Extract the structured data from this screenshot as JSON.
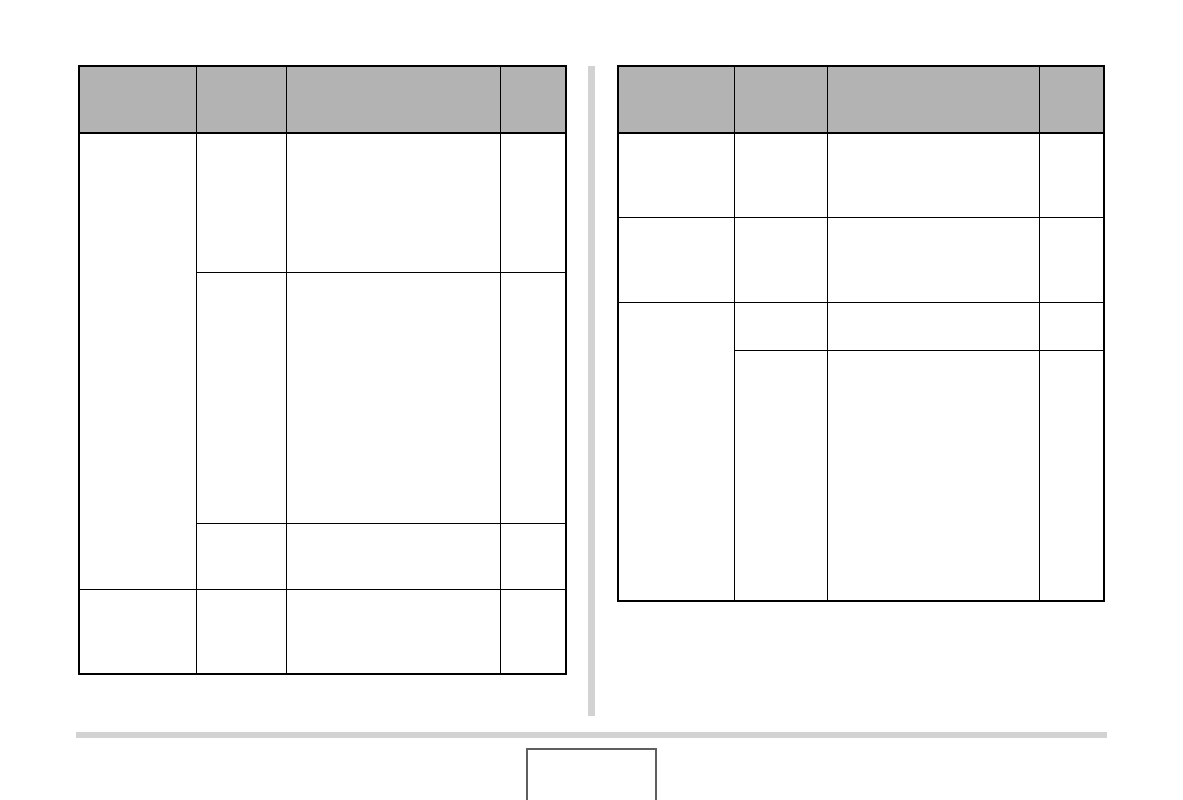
{
  "page": {
    "background_color": "#ffffff"
  },
  "colors": {
    "table_header_fill": "#b3b3b3",
    "table_border": "#000000",
    "column_divider": "#d2d2d2",
    "footer_rule": "#d2d2d2",
    "page_number_box_border": "#5f5f5f"
  },
  "left_table": {
    "columns": 4,
    "header_labels": [
      "",
      "",
      "",
      ""
    ],
    "rows": [
      {
        "cells": [
          "",
          "",
          "",
          ""
        ]
      },
      {
        "cells": [
          "",
          "",
          ""
        ]
      },
      {
        "cells": [
          "",
          "",
          ""
        ]
      },
      {
        "cells": [
          "",
          "",
          "",
          ""
        ]
      }
    ]
  },
  "right_table": {
    "columns": 4,
    "header_labels": [
      "",
      "",
      "",
      ""
    ],
    "rows": [
      {
        "cells": [
          "",
          "",
          "",
          ""
        ]
      },
      {
        "cells": [
          "",
          "",
          "",
          ""
        ]
      },
      {
        "cells": [
          "",
          "",
          "",
          ""
        ]
      },
      {
        "cells": [
          "",
          "",
          ""
        ]
      }
    ]
  },
  "page_number_box": {
    "text": ""
  }
}
